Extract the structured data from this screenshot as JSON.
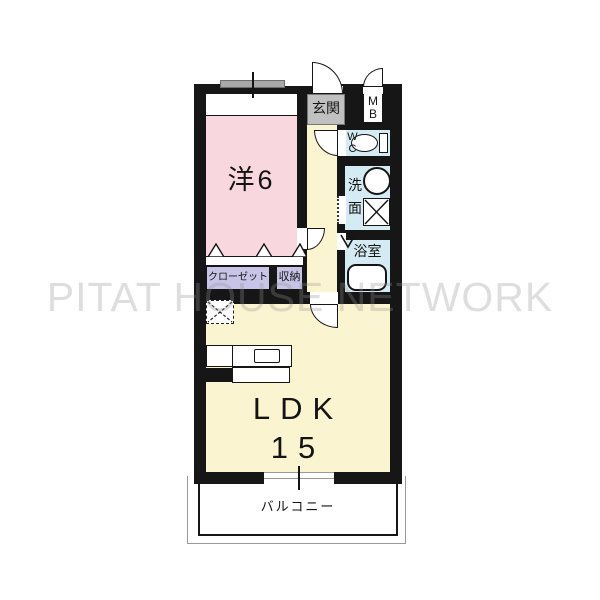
{
  "watermark": "PITAT HOUSE NETWORK",
  "colors": {
    "wall": "#161616",
    "room-pink": "#f8d7df",
    "room-yellow": "#fbf4d0",
    "room-blue": "#d5ebf3",
    "closet-lavender": "#c8c4e7",
    "entrance-gray": "#c1c0c0",
    "line-gray": "#9a9a9a",
    "watermark-gray": "rgba(145,145,145,0.30)"
  },
  "rooms": {
    "western": {
      "label": "洋6"
    },
    "ldk": {
      "line1": "LDK",
      "line2": "15"
    },
    "balcony": {
      "label": "バルコニー"
    },
    "entrance": {
      "label": "玄関"
    },
    "meter_box": {
      "line1": "M",
      "line2": "B"
    },
    "wc": {
      "line1": "W",
      "line2": "C"
    },
    "washroom": {
      "line1": "洗",
      "line2": "面"
    },
    "bathroom": {
      "label": "浴室"
    },
    "closet": {
      "label": "クローゼット"
    },
    "storage": {
      "label": "収納"
    }
  }
}
